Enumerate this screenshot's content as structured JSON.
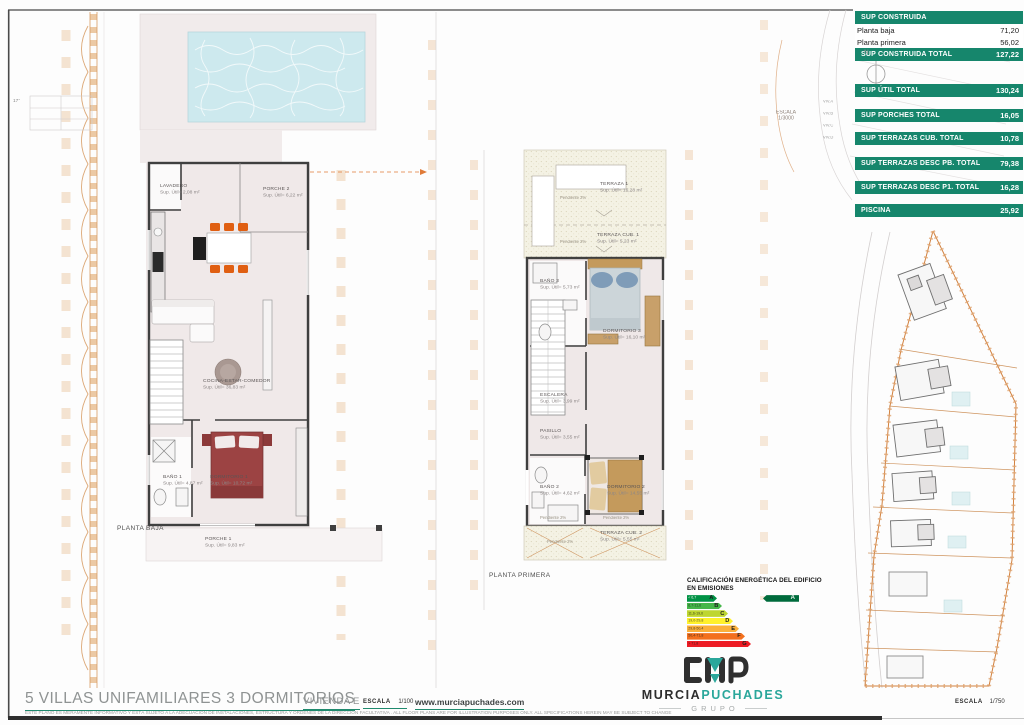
{
  "colors": {
    "accent_green": "#16866c",
    "brand_teal": "#2aa79b",
    "orange_boundary": "#d1813f",
    "plan_pink": "#f1ebeb",
    "pool_blue": "#cde9ee"
  },
  "areas_table": {
    "title_row": "SUP CONSTRUIDA",
    "sub_rows": [
      {
        "label": "Planta baja",
        "value": "71,20"
      },
      {
        "label": "Planta primera",
        "value": "56,02"
      }
    ],
    "total_rows": [
      {
        "label": "SUP CONSTRUIDA TOTAL",
        "value": "127,22"
      },
      {
        "label": "SUP ÚTIL TOTAL",
        "value": "130,24"
      },
      {
        "label": "SUP PORCHES TOTAL",
        "value": "16,05"
      },
      {
        "label": "SUP TERRAZAS CUB. TOTAL",
        "value": "10,78"
      },
      {
        "label": "SUP TERRAZAS DESC PB. TOTAL",
        "value": "79,38"
      },
      {
        "label": "SUP TERRAZAS DESC P1. TOTAL",
        "value": "16,28"
      },
      {
        "label": "PISCINA",
        "value": "25,92"
      }
    ]
  },
  "planta_baja": {
    "label": "PLANTA BAJA",
    "rooms": [
      {
        "name": "LAVADERO",
        "area": "Sup. Útil= 2,08 m²"
      },
      {
        "name": "PORCHE 2",
        "area": "Sup. Útil= 6,22 m²"
      },
      {
        "name": "COCINA-ESTAR-COMEDOR",
        "area": "Sup. Útil= 36,83 m²"
      },
      {
        "name": "BAÑO 1",
        "area": "Sup. Útil= 4,87 m²"
      },
      {
        "name": "DORMITORIO 1",
        "area": "Sup. Útil= 10,72 m²"
      },
      {
        "name": "PORCHE 1",
        "area": "Sup. Útil= 9,83 m²"
      }
    ]
  },
  "planta_primera": {
    "label": "PLANTA PRIMERA",
    "pendiente": "Pendiente  2%",
    "rooms": [
      {
        "name": "TERRAZA  1",
        "area": "Sup. Útil= 16,28 m²"
      },
      {
        "name": "TERRAZA CUB. 1",
        "area": "Sup. Útil= 5,23 m²"
      },
      {
        "name": "BAÑO 3",
        "area": "Sup. Útil= 5,73 m²"
      },
      {
        "name": "DORMITORIO 3",
        "area": "Sup. Útil= 16,10 m²"
      },
      {
        "name": "ESCALERA",
        "area": "Sup. Útil= 3,99 m²"
      },
      {
        "name": "PASILLO",
        "area": "Sup. Útil= 3,55 m²"
      },
      {
        "name": "BAÑO 2",
        "area": "Sup. Útil= 4,62 m²"
      },
      {
        "name": "DORMITORIO 2",
        "area": "Sup. Útil= 14,55 m²"
      },
      {
        "name": "TERRAZA  CUB. 2",
        "area": "Sup. Útil= 5,55 m²"
      }
    ]
  },
  "energy": {
    "title_line1": "CALIFICACIÓN ENERGÉTICA DEL EDIFICIO",
    "title_line2": "EN EMISIONES",
    "rows": [
      {
        "range": "< 6,7",
        "letter": "A",
        "color": "#009245"
      },
      {
        "range": "6,7-11,6",
        "letter": "B",
        "color": "#45b649"
      },
      {
        "range": "11,6-19,0",
        "letter": "C",
        "color": "#bed630"
      },
      {
        "range": "19,0-29,8",
        "letter": "D",
        "color": "#fff12c"
      },
      {
        "range": "29,8-50,4",
        "letter": "E",
        "color": "#fbb03b"
      },
      {
        "range": "50,4-71,8",
        "letter": "F",
        "color": "#f3701e"
      },
      {
        "range": "> 71,8",
        "letter": "G",
        "color": "#ed1c24"
      }
    ],
    "indicator_letter": "A",
    "indicator_color": "#006b3c"
  },
  "brand": {
    "name_left": "MURCIA",
    "name_right": "PUCHADES",
    "sub": "GRUPO"
  },
  "titleblock": {
    "title": "5 VILLAS UNIFAMILIARES 3 DORMITORIOS",
    "vivienda": "VIVIENDA E",
    "escala_label": "ESCALA",
    "escala_value": "1/100",
    "website": "www.murciapuchades.com",
    "disclaimer": "ESTE PLANO ES MERAMENTE INFORMATIVO Y ESTÁ SUJETO A LA ADECUACIÓN DE INSTALACIONES, ESTRUCTURA Y ÓRDENES DE LA DIRECCIÓN FACULTATIVA . ALL FLOOR PLANS ARE FOR ILLUSTRATION PURPOSES ONLY. ALL SPECIFICATIONS HEREIN MAY BE SUBJECT TO CHANGE"
  },
  "site": {
    "small_scale_label": "ESCALA",
    "small_scale_value": "1/3000",
    "large_scale_label": "ESCALA",
    "large_scale_value": "1/750",
    "mini_plots": [
      "VIV.A",
      "VIV.B",
      "VIV.C",
      "VIV.D"
    ],
    "compass": "N",
    "corner_note": "17°"
  }
}
